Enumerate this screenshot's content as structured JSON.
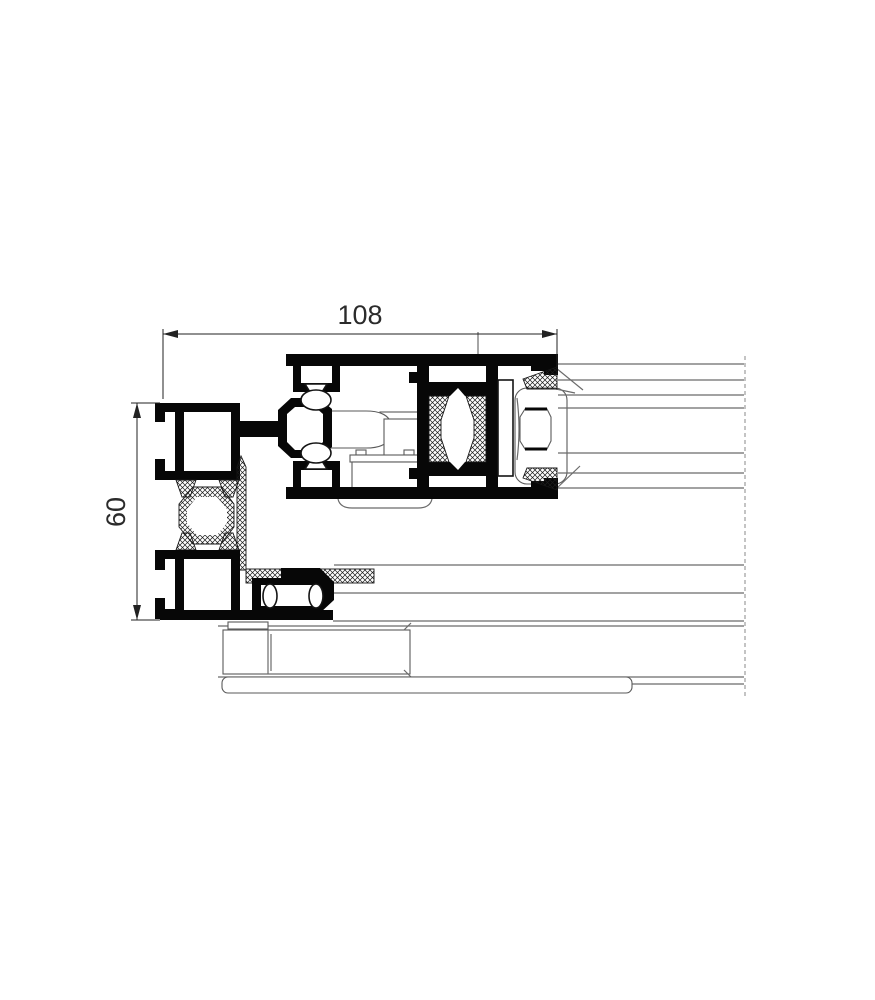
{
  "drawing": {
    "type": "technical-cross-section",
    "subject": "aluminium-window-profile-section",
    "dim_width_label": "108",
    "dim_height_label": "60",
    "colors": {
      "profile_fill": "#070707",
      "thin_line": "#6b6b6b",
      "dimension_line": "#222222",
      "hatch_line": "#1c1c1c",
      "cut_line": "#8a8a8a",
      "background": "#ffffff"
    }
  }
}
